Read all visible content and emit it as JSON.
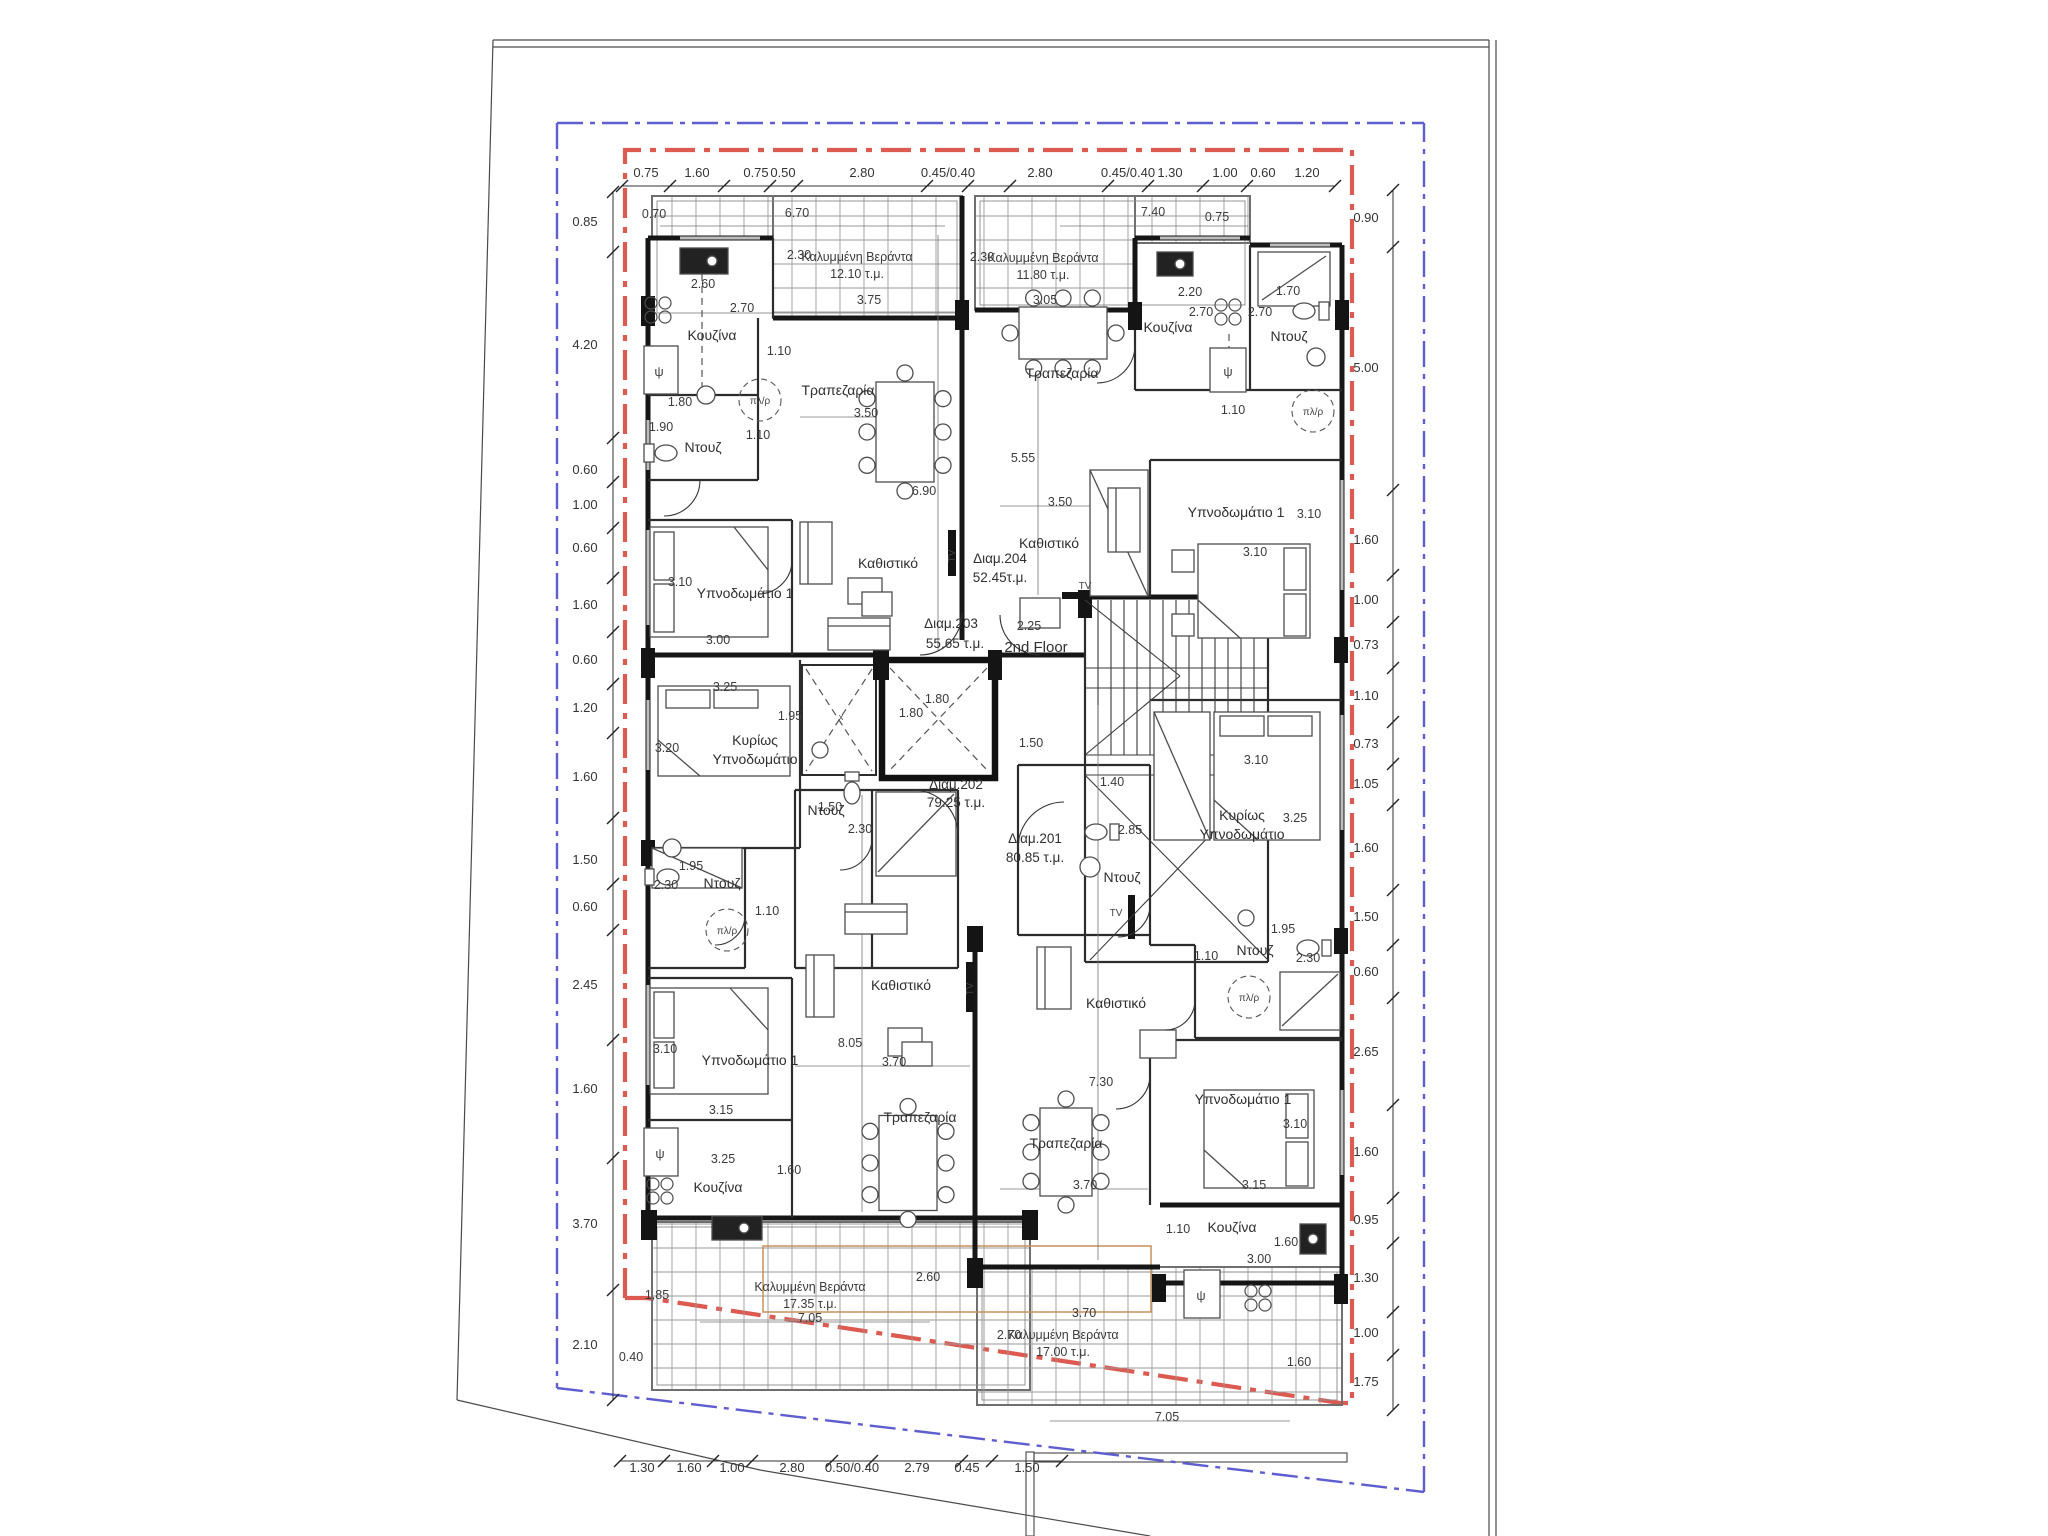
{
  "plan": {
    "floor_label": "2nd Floor",
    "apartments": [
      {
        "id": "apt-201",
        "name": "Διαμ.201",
        "area": "80.85 τ.μ."
      },
      {
        "id": "apt-202",
        "name": "Διαμ.202",
        "area": "79.25 τ.μ."
      },
      {
        "id": "apt-203",
        "name": "Διαμ.203",
        "area": "55.65 τ.μ."
      },
      {
        "id": "apt-204",
        "name": "Διαμ.204",
        "area": "52.45τ.μ."
      }
    ],
    "verandas": [
      {
        "id": "veranda-203",
        "name": "Καλυμμένη Βεράντα",
        "area": "12.10 τ.μ."
      },
      {
        "id": "veranda-204",
        "name": "Καλυμμένη Βεράντα",
        "area": "11.80 τ.μ."
      },
      {
        "id": "veranda-202",
        "name": "Καλυμμένη Βεράντα",
        "area": "17.35 τ.μ."
      },
      {
        "id": "veranda-201",
        "name": "Καλυμμένη Βεράντα",
        "area": "17.00 τ.μ."
      }
    ],
    "rooms": [
      {
        "id": "kouzina-203",
        "label": "Κουζίνα"
      },
      {
        "id": "ntouz-203",
        "label": "Ντουζ"
      },
      {
        "id": "trapezaria-203",
        "label": "Τραπεζαρία"
      },
      {
        "id": "kathistiko-203",
        "label": "Καθιστικό"
      },
      {
        "id": "ypnodomatio1-203",
        "label": "Υπνοδωμάτιο 1"
      },
      {
        "id": "kouzina-204",
        "label": "Κουζίνα"
      },
      {
        "id": "ntouz-204",
        "label": "Ντουζ"
      },
      {
        "id": "trapezaria-204",
        "label": "Τραπεζαρία"
      },
      {
        "id": "kathistiko-204",
        "label": "Καθιστικό"
      },
      {
        "id": "ypnodomatio1-204",
        "label": "Υπνοδωμάτιο 1"
      },
      {
        "id": "kyrios-ypnodomatio-202",
        "label": "Κυρίως Υπνοδωμάτιο",
        "multiline": true
      },
      {
        "id": "ntouz-202-left",
        "label": "Ντουζ"
      },
      {
        "id": "ntouz-202-center",
        "label": "Ντουζ"
      },
      {
        "id": "kathistiko-202",
        "label": "Καθιστικό"
      },
      {
        "id": "ypnodomatio1-202",
        "label": "Υπνοδωμάτιο 1"
      },
      {
        "id": "kouzina-202",
        "label": "Κουζίνα"
      },
      {
        "id": "trapezaria-202",
        "label": "Τραπεζαρία"
      },
      {
        "id": "kyrios-ypnodomatio-201",
        "label": "Κυρίως Υπνοδωμάτιο",
        "multiline": true
      },
      {
        "id": "ntouz-201-top",
        "label": "Ντουζ"
      },
      {
        "id": "ntouz-201-lower",
        "label": "Ντουζ"
      },
      {
        "id": "kathistiko-201",
        "label": "Καθιστικό"
      },
      {
        "id": "trapezaria-201",
        "label": "Τραπεζαρία"
      },
      {
        "id": "ypnodomatio1-201",
        "label": "Υπνοδωμάτιο 1"
      },
      {
        "id": "kouzina-201",
        "label": "Κουζίνα"
      }
    ],
    "fixtures": [
      {
        "id": "plir-203",
        "label": "πλ/ρ"
      },
      {
        "id": "plir-204",
        "label": "πλ/ρ"
      },
      {
        "id": "plir-202",
        "label": "πλ/ρ"
      },
      {
        "id": "plir-201",
        "label": "πλ/ρ"
      },
      {
        "id": "psi-203",
        "label": "ψ"
      },
      {
        "id": "psi-204",
        "label": "ψ"
      },
      {
        "id": "psi-202",
        "label": "ψ"
      },
      {
        "id": "psi-201",
        "label": "ψ"
      },
      {
        "id": "tv-203",
        "label": "TV"
      },
      {
        "id": "tv-204",
        "label": "TV"
      },
      {
        "id": "tv-202",
        "label": "TV"
      },
      {
        "id": "tv-201",
        "label": "TV"
      },
      {
        "id": "shaft-x",
        "label": "x"
      }
    ],
    "dimension_chains": {
      "top": [
        "0.75",
        "1.60",
        "0.75",
        "0.50",
        "2.80",
        "0.45/0.40",
        "2.80",
        "0.45/0.40",
        "1.30",
        "1.00",
        "0.60",
        "1.20"
      ],
      "bottom": [
        "1.30",
        "1.60",
        "1.00",
        "2.80",
        "0.50/0.40",
        "2.79",
        "0.45",
        "1.50"
      ],
      "left": [
        "0.85",
        "4.20",
        "0.60",
        "1.00",
        "0.60",
        "1.60",
        "0.60",
        "1.20",
        "1.60",
        "1.50",
        "0.60",
        "2.45",
        "1.60",
        "3.70",
        "2.10"
      ],
      "right": [
        "0.90",
        "5.00",
        "1.60",
        "1.00",
        "0.73",
        "1.10",
        "0.73",
        "1.05",
        "1.60",
        "1.50",
        "0.60",
        "2.65",
        "1.60",
        "0.95",
        "1.30",
        "1.00",
        "1.75"
      ]
    },
    "interior_dimensions": [
      "0.70",
      "6.70",
      "2.30",
      "3.75",
      "2.60",
      "2.70",
      "1.10",
      "3.50",
      "1.80",
      "1.90",
      "1.10",
      "3.10",
      "3.00",
      "6.90",
      "7.40",
      "0.75",
      "2.30",
      "3.05",
      "2.20",
      "2.70",
      "2.70",
      "1.70",
      "1.10",
      "5.55",
      "3.50",
      "3.10",
      "3.10",
      "2.25",
      "1.50",
      "1.80",
      "1.80",
      "3.25",
      "1.95",
      "3.20",
      "1.50",
      "2.30",
      "1.95",
      "2.30",
      "1.10",
      "8.05",
      "3.70",
      "3.10",
      "3.15",
      "3.25",
      "1.60",
      "2.60",
      "7.05",
      "1.85",
      "0.40",
      "1.40",
      "2.85",
      "3.10",
      "3.25",
      "1.95",
      "2.30",
      "1.10",
      "7.30",
      "3.70",
      "3.10",
      "3.15",
      "1.10",
      "1.60",
      "3.00",
      "3.70",
      "2.70",
      "1.60",
      "7.05"
    ],
    "colors": {
      "envelope_red": "#dd5a50",
      "boundary_blue": "#5e5ed0",
      "veranda_grid": "#9a9a9a",
      "tan_line": "#c89058",
      "wall": "#161616"
    }
  }
}
